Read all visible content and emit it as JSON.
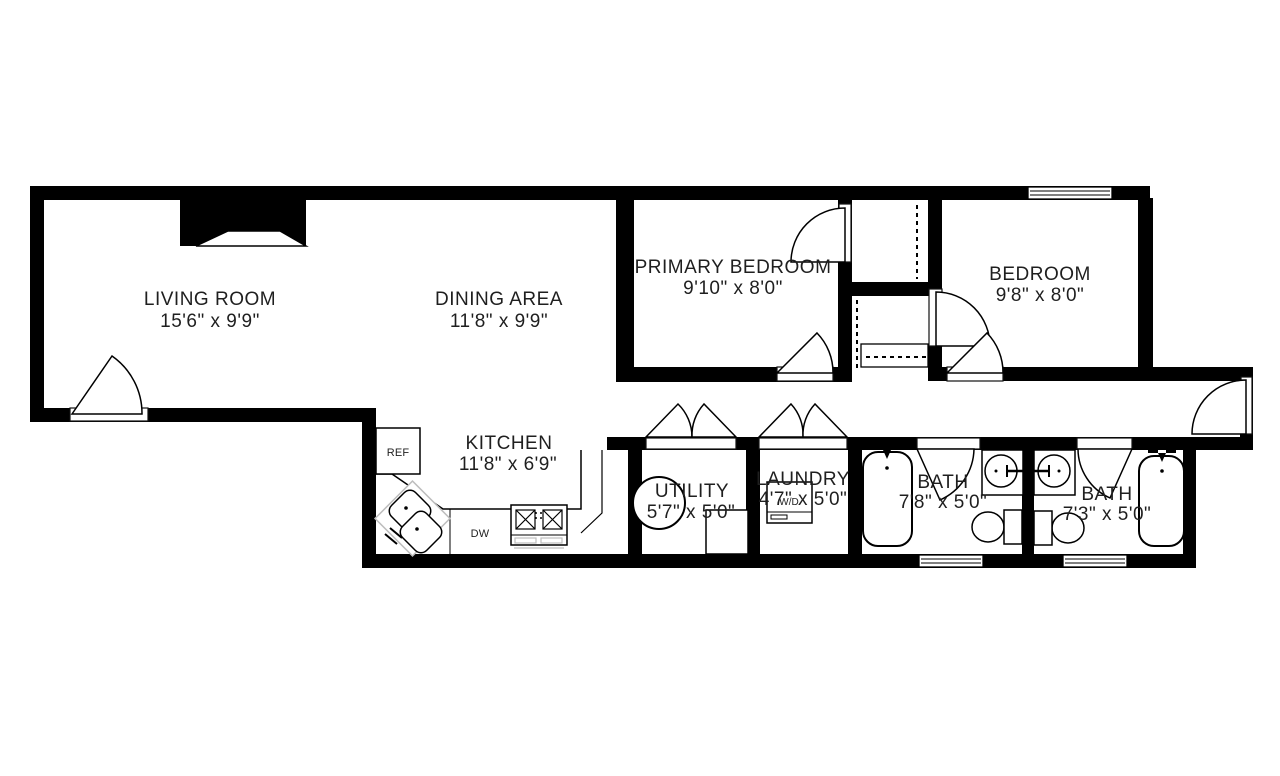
{
  "plan_type": "floor-plan",
  "rooms": [
    {
      "name": "LIVING ROOM",
      "dims": "15'6\" x 9'9\""
    },
    {
      "name": "DINING AREA",
      "dims": "11'8\" x 9'9\""
    },
    {
      "name": "PRIMARY BEDROOM",
      "dims": "9'10\" x 8'0\""
    },
    {
      "name": "BEDROOM",
      "dims": "9'8\" x 8'0\""
    },
    {
      "name": "KITCHEN",
      "dims": "11'8\" x 6'9\""
    },
    {
      "name": "UTILITY",
      "dims": "5'7\" x 5'0\""
    },
    {
      "name": "LAUNDRY",
      "dims": "4'7\" x 5'0\""
    },
    {
      "name": "BATH",
      "dims": "7'8\" x 5'0\""
    },
    {
      "name": "BATH",
      "dims": "7'3\" x 5'0\""
    }
  ],
  "appliances": {
    "refrigerator": "REF",
    "dishwasher": "DW",
    "washer_dryer": "W/D"
  },
  "colors": {
    "wall": "#000000",
    "line": "#000000",
    "text": "#1f1f1f",
    "ghost": "#bdbdbd",
    "background": "#ffffff"
  }
}
